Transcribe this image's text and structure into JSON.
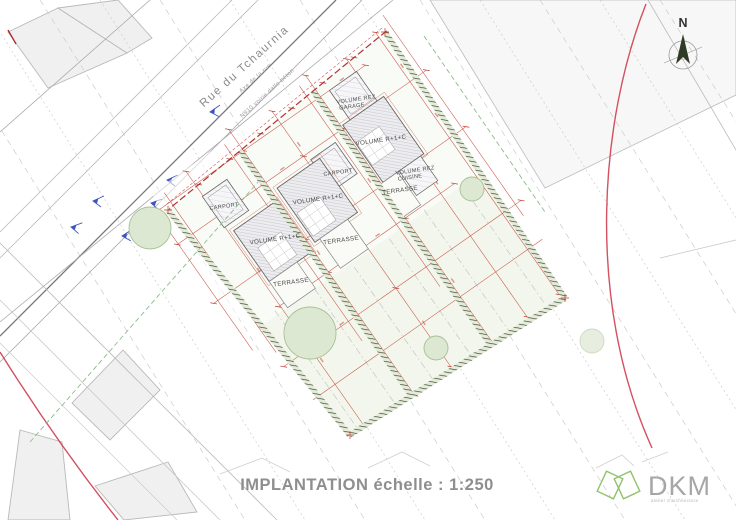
{
  "title": {
    "text": "IMPLANTATION échelle : 1:250"
  },
  "compass": {
    "label": "N"
  },
  "street": {
    "name": "Rue du Tchaurnia",
    "axis_label": "Axe de la rue",
    "surface_label": "N910 voirie dalle béton"
  },
  "plan": {
    "labels": {
      "volume_r1c": "VOLUME R+1+C",
      "volume_rez": "VOLUME REZ",
      "garage": "GARAGE",
      "cuisine": "CUISINE",
      "carport": "CARPORT",
      "terrasse": "TERRASSE"
    }
  },
  "logo": {
    "name": "DKM",
    "subtitle": "atelier d'architecture"
  },
  "colors": {
    "dimension_red": "#c0392b",
    "survey_red": "#cc3344",
    "boundary_hatch_dark": "#2f3b26",
    "boundary_hatch_light": "#e4ecd9",
    "parcel_fill": "#f2f6ec",
    "tree_fill": "#dde8d2",
    "tree_stroke": "#a9c096",
    "arrow_blue": "#3f55b8",
    "contour_gray": "#cccccc",
    "title_gray": "#8e8e8e",
    "logo_green": "#8fc36a",
    "logo_gray": "#a6a6a6"
  }
}
